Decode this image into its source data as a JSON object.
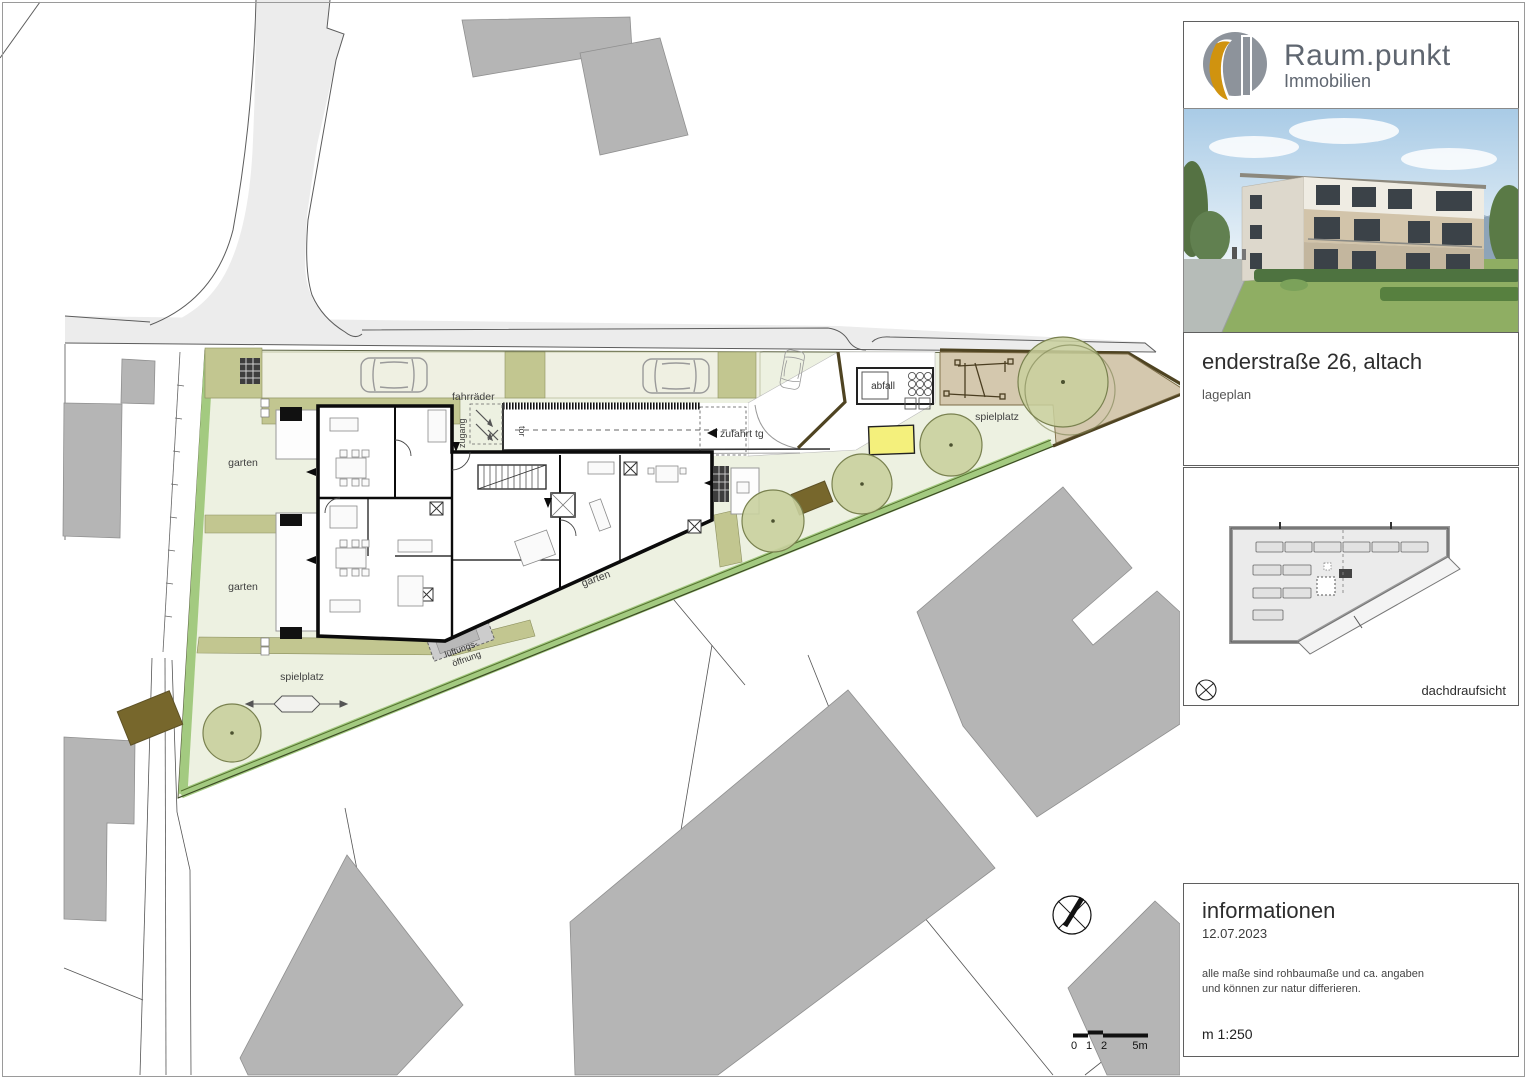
{
  "plan": {
    "labels": {
      "garten": "garten",
      "spielplatz": "spielplatz",
      "fahrraeder": "fahrräder",
      "tor": "tor",
      "zugang": "zugang",
      "zufahrt_tg": "zufahrt tg",
      "abfall": "abfall",
      "lueftung1": "lüftungs-",
      "lueftung2": "öffnung"
    },
    "scalebar": {
      "t0": "0",
      "t1": "1",
      "t2": "2",
      "t5": "5m"
    }
  },
  "sidebar": {
    "brand": {
      "name": "Raum.punkt",
      "sub": "Immobilien"
    },
    "title": "enderstraße 26, altach",
    "subtitle": "lageplan",
    "roof_caption": "dachdraufsicht",
    "info": {
      "heading": "informationen",
      "date": "12.07.2023",
      "note1": "alle maße sind rohbaumaße und ca. angaben",
      "note2": "und können zur natur differieren.",
      "scale": "m 1:250"
    }
  },
  "colors": {
    "lawn": "#edf1e1",
    "hedge": "#a3ca80",
    "olive": "#c2c690",
    "tree": "#c9d09e",
    "playground_tan": "#d4c8ae",
    "fence_brown": "#4f4422",
    "marker_yellow": "#f4f07c",
    "neighbor_gray": "#b5b5b5",
    "road_gray": "#ececec",
    "brand_gold": "#d0930f",
    "brand_gray": "#8d939b"
  }
}
